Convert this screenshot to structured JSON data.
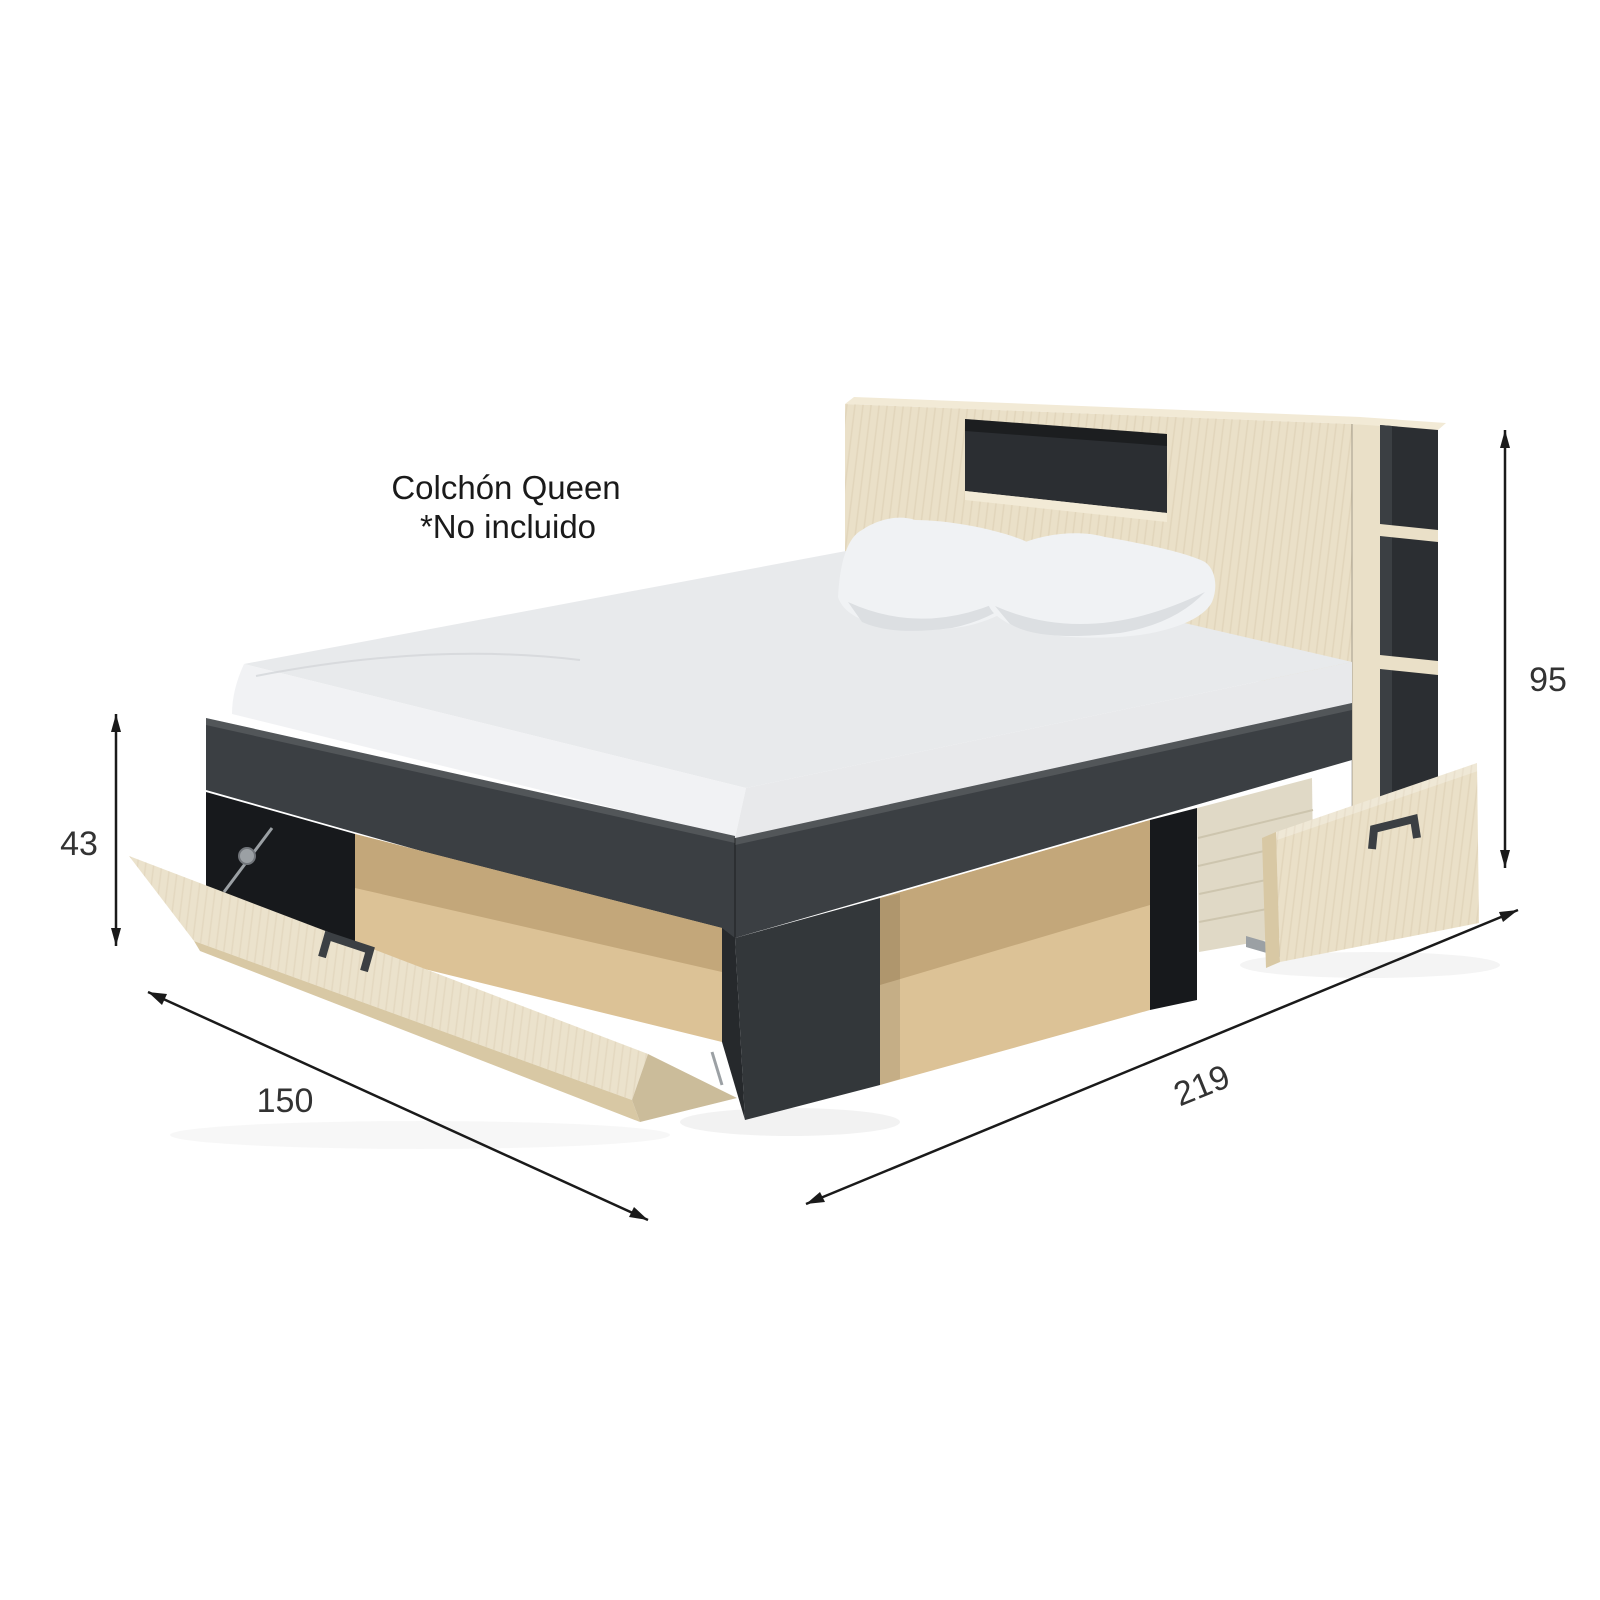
{
  "annotation": {
    "line1": "Colchón Queen",
    "line2": "*No incluido"
  },
  "dimensions": {
    "total_height": "95",
    "footboard_height": "43",
    "width": "150",
    "length": "219"
  },
  "colors": {
    "background": "#ffffff",
    "wood": "#EAE0C8",
    "wood_top": "#F2EAD6",
    "wood_edge": "#D8C8A4",
    "wood_interior_back": "#C3A77A",
    "wood_interior_floor": "#DCC296",
    "dark": "#3B3F43",
    "dark_opening": "#2B2E32",
    "dark_deep": "#17191C",
    "mattress": "#E8EAEC",
    "mattress_side": "#F1F2F4",
    "pillow": "#F0F2F4",
    "pillow_shade": "#DCDFE2",
    "basket": "#E0D9C6",
    "basket_shade": "#CDC5AE",
    "metal": "#9BA0A4",
    "dimension_line": "#1A1A1A",
    "dimension_text": "#333333",
    "annotation_text": "#1A1A1A"
  }
}
